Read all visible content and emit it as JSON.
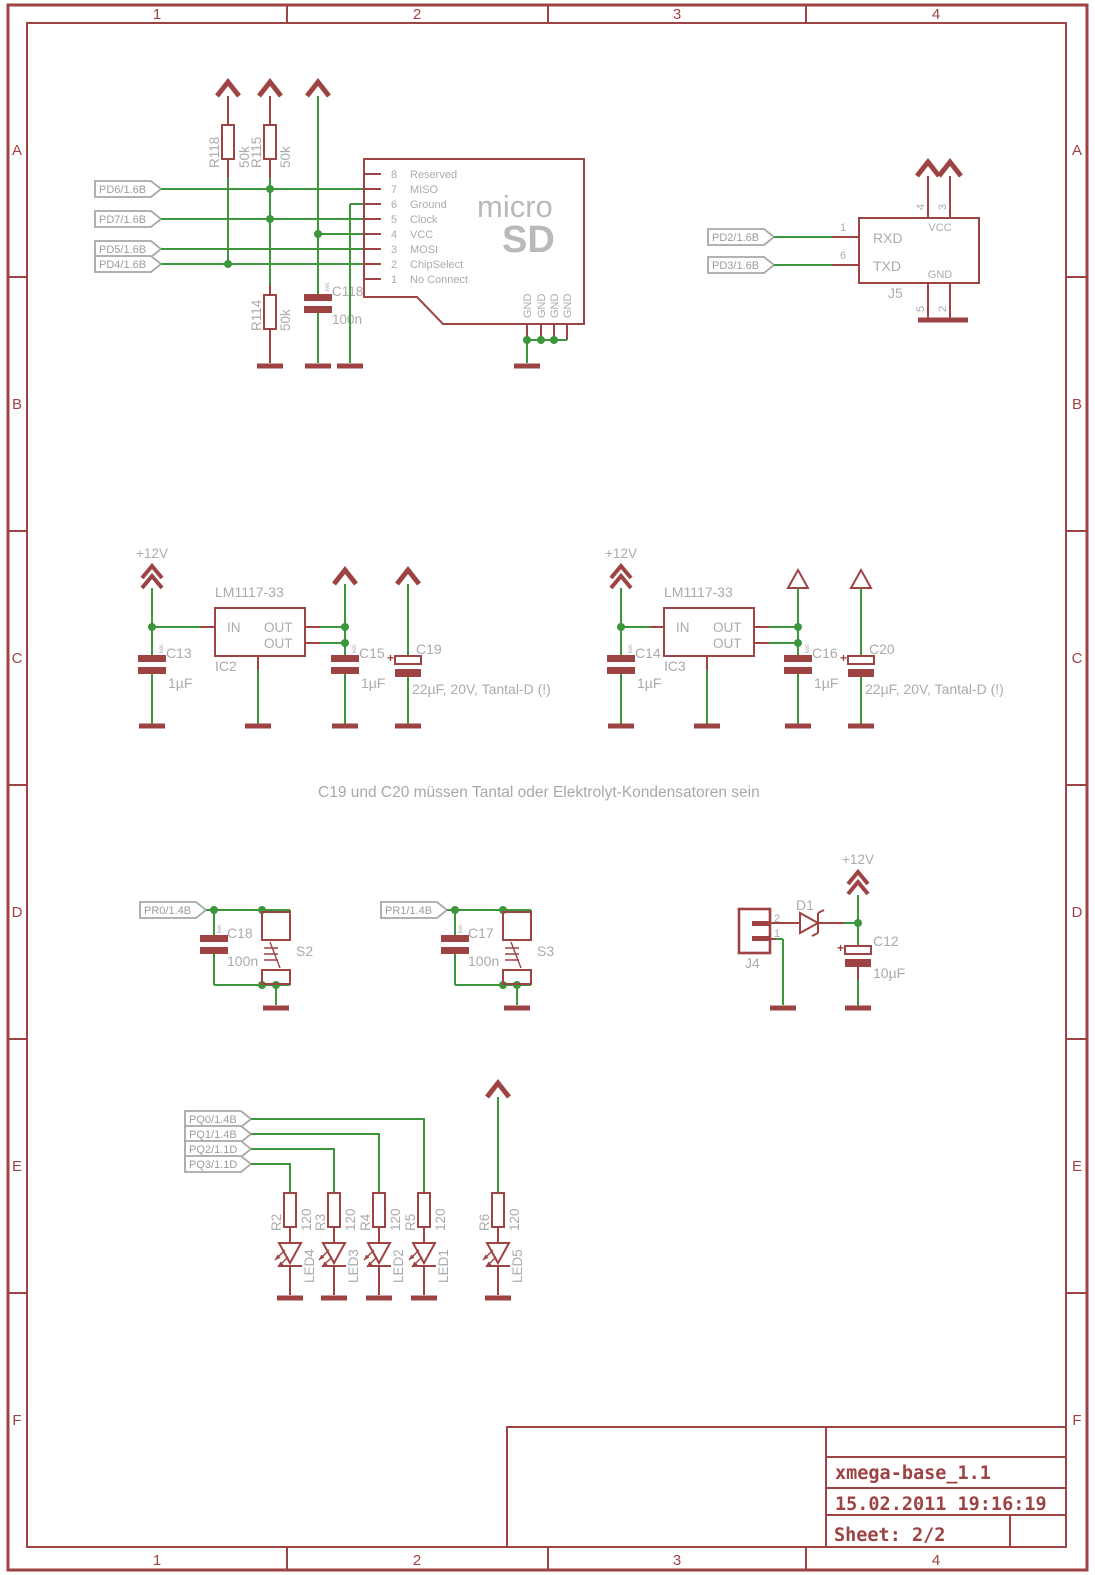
{
  "colors": {
    "symbol": "#9e4343",
    "net": "#3c963c",
    "text_gray": "#ababab"
  },
  "frame": {
    "cols": [
      "1",
      "2",
      "3",
      "4"
    ],
    "rows": [
      "A",
      "B",
      "C",
      "D",
      "E",
      "F"
    ]
  },
  "title_block": {
    "project": "xmega-base_1.1",
    "timestamp": "15.02.2011 19:16:19",
    "sheet": "Sheet: 2/2"
  },
  "note": "C19 und C20 müssen Tantal oder Elektrolyt-Kondensatoren sein",
  "sd": {
    "nets": [
      "PD6/1.6B",
      "PD7/1.6B",
      "PD5/1.6B",
      "PD4/1.6B"
    ],
    "pullups": [
      {
        "ref": "R118",
        "value": "50k"
      },
      {
        "ref": "R115",
        "value": "50k"
      },
      {
        "ref": "R114",
        "value": "50k"
      }
    ],
    "cap": {
      "ref": "C118",
      "value": "100n",
      "hint": "ker."
    },
    "pins": [
      {
        "num": "8",
        "name": "Reserved"
      },
      {
        "num": "7",
        "name": "MISO"
      },
      {
        "num": "6",
        "name": "Ground"
      },
      {
        "num": "5",
        "name": "Clock"
      },
      {
        "num": "4",
        "name": "VCC"
      },
      {
        "num": "3",
        "name": "MOSI"
      },
      {
        "num": "2",
        "name": "ChipSelect"
      },
      {
        "num": "1",
        "name": "No Connect"
      }
    ],
    "gnd_pins": [
      "GND",
      "GND",
      "GND",
      "GND"
    ],
    "logo_top": "micro",
    "logo_bottom": "SD"
  },
  "uart": {
    "ref": "J5",
    "nets": [
      "PD2/1.6B",
      "PD3/1.6B"
    ],
    "pins": [
      {
        "num": "1",
        "name": "RXD"
      },
      {
        "num": "6",
        "name": "TXD"
      }
    ],
    "vcc": {
      "name": "VCC",
      "pin_nums": [
        "4",
        "3"
      ]
    },
    "gnd": {
      "name": "GND",
      "pin_nums": [
        "5",
        "2"
      ]
    }
  },
  "regulators": [
    {
      "ref": "IC2",
      "part": "LM1117-33",
      "pin_in": "IN",
      "pin_out1": "OUT",
      "pin_out2": "OUT",
      "supply": "+12V",
      "cin": {
        "ref": "C13",
        "value": "1µF",
        "hint": "ker."
      },
      "cout": {
        "ref": "C15",
        "value": "1µF",
        "hint": "ker."
      },
      "cbulk": {
        "ref": "C19",
        "plus": "+",
        "value": "22µF, 20V, Tantal-D (!)"
      }
    },
    {
      "ref": "IC3",
      "part": "LM1117-33",
      "pin_in": "IN",
      "pin_out1": "OUT",
      "pin_out2": "OUT",
      "supply": "+12V",
      "cin": {
        "ref": "C14",
        "value": "1µF",
        "hint": "ker."
      },
      "cout": {
        "ref": "C16",
        "value": "1µF",
        "hint": "ker."
      },
      "cbulk": {
        "ref": "C20",
        "plus": "+",
        "value": "22µF, 20V, Tantal-D (!)"
      }
    }
  ],
  "buttons": [
    {
      "net": "PR0/1.4B",
      "ref": "S2",
      "cap": {
        "ref": "C18",
        "value": "100n",
        "hint": "ker."
      }
    },
    {
      "net": "PR1/1.4B",
      "ref": "S3",
      "cap": {
        "ref": "C17",
        "value": "100n",
        "hint": "ker."
      }
    }
  ],
  "power_input": {
    "ref": "J4",
    "pin_top": "2",
    "pin_bottom": "1",
    "diode": "D1",
    "supply": "+12V",
    "cap": {
      "ref": "C12",
      "plus": "+",
      "value": "10µF"
    }
  },
  "led_bank": {
    "nets": [
      "PQ0/1.4B",
      "PQ1/1.4B",
      "PQ2/1.1D",
      "PQ3/1.1D"
    ],
    "resistors": [
      {
        "ref": "R2",
        "value": "120"
      },
      {
        "ref": "R3",
        "value": "120"
      },
      {
        "ref": "R4",
        "value": "120"
      },
      {
        "ref": "R5",
        "value": "120"
      },
      {
        "ref": "R6",
        "value": "120"
      }
    ],
    "leds": [
      "LED4",
      "LED3",
      "LED2",
      "LED1",
      "LED5"
    ]
  }
}
